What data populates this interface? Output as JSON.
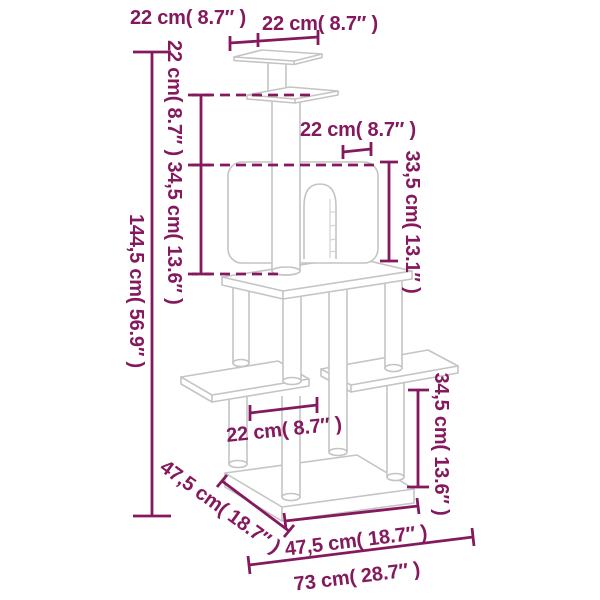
{
  "diagram": {
    "title": "Cat tree dimension diagram",
    "colors": {
      "dimension_lines": "#84195d",
      "product_outline": "#c4c4c4",
      "background": "#ffffff"
    },
    "labels": {
      "top_platform_depth": "22 cm( 8.7″ )",
      "top_platform_width": "22 cm( 8.7″ )",
      "top_section_height": "22 cm( 8.7″ )",
      "middle_section_height": "34,5 cm( 13.6″ )",
      "total_height": "144,5 cm( 56.9″ )",
      "condo_door_width": "22 cm( 8.7″ )",
      "condo_height": "33,5 cm( 13.1″ )",
      "lower_platform_width": "22 cm( 8.7″ )",
      "lower_right_section_height": "34,5 cm( 13.6″ )",
      "base_depth": "47,5 cm( 18.7″ )",
      "base_front_width": "47,5 cm( 18.7″ )",
      "base_total_width": "73 cm( 28.7″ )"
    }
  }
}
